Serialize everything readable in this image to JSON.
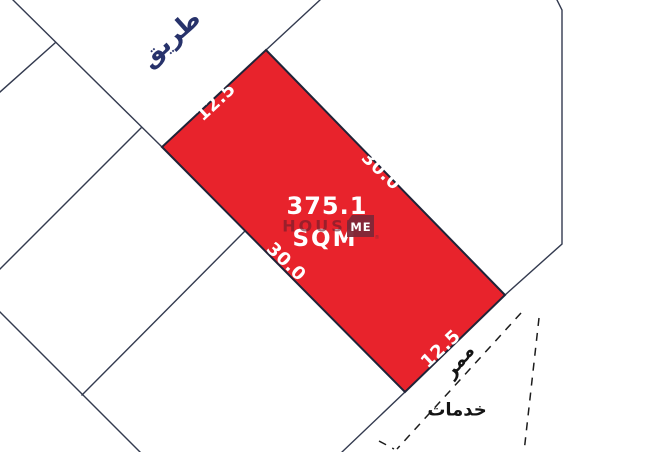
{
  "diagram": {
    "type": "land-plot-survey-map",
    "road_label": "طريق",
    "passage_label": "ممر",
    "services_label": "خدمات",
    "plot": {
      "area_value": "375.1",
      "area_unit": "SQM",
      "dim_top": "12.5",
      "dim_right": "30.0",
      "dim_left": "30.0",
      "dim_bottom": "12.5"
    },
    "watermark": {
      "word1": "HOUSE",
      "word2": "ME",
      "registered_mark": "®"
    },
    "colors": {
      "background": "#FFFFFF",
      "plot_fill": "#E8232C",
      "plot_stroke": "#1F2438",
      "boundary_line": "#333A4F",
      "dashed_line": "#1C1C1C",
      "road_label_color": "#27326B",
      "black_label_color": "#141414",
      "dimension_text": "#FFFFFF",
      "watermark_box": "#7E2838",
      "watermark_text": "#6B1D2C"
    }
  }
}
